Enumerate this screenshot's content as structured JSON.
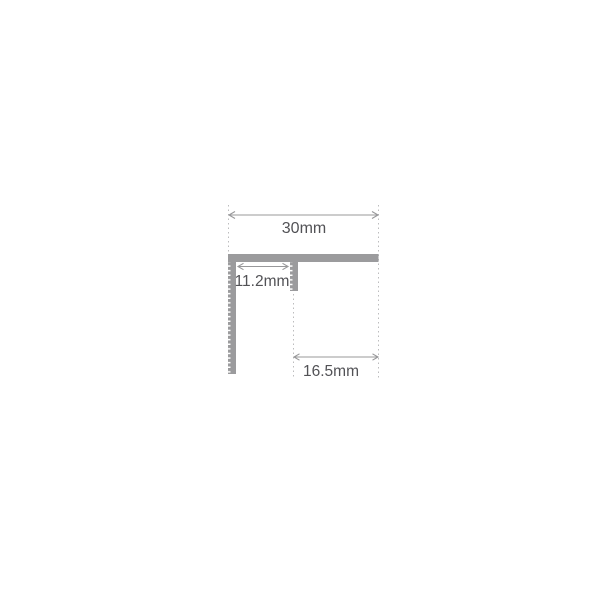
{
  "diagram": {
    "dimensions": {
      "overall_width": {
        "label": "30mm"
      },
      "inner_width": {
        "label": "11.2mm"
      },
      "base_width": {
        "label": "16.5mm"
      }
    },
    "colors": {
      "background": "#ffffff",
      "profile": "#9b9b9d",
      "dimension_line": "#98989a",
      "extension_line": "#bcbcbe",
      "text": "#525256"
    }
  }
}
